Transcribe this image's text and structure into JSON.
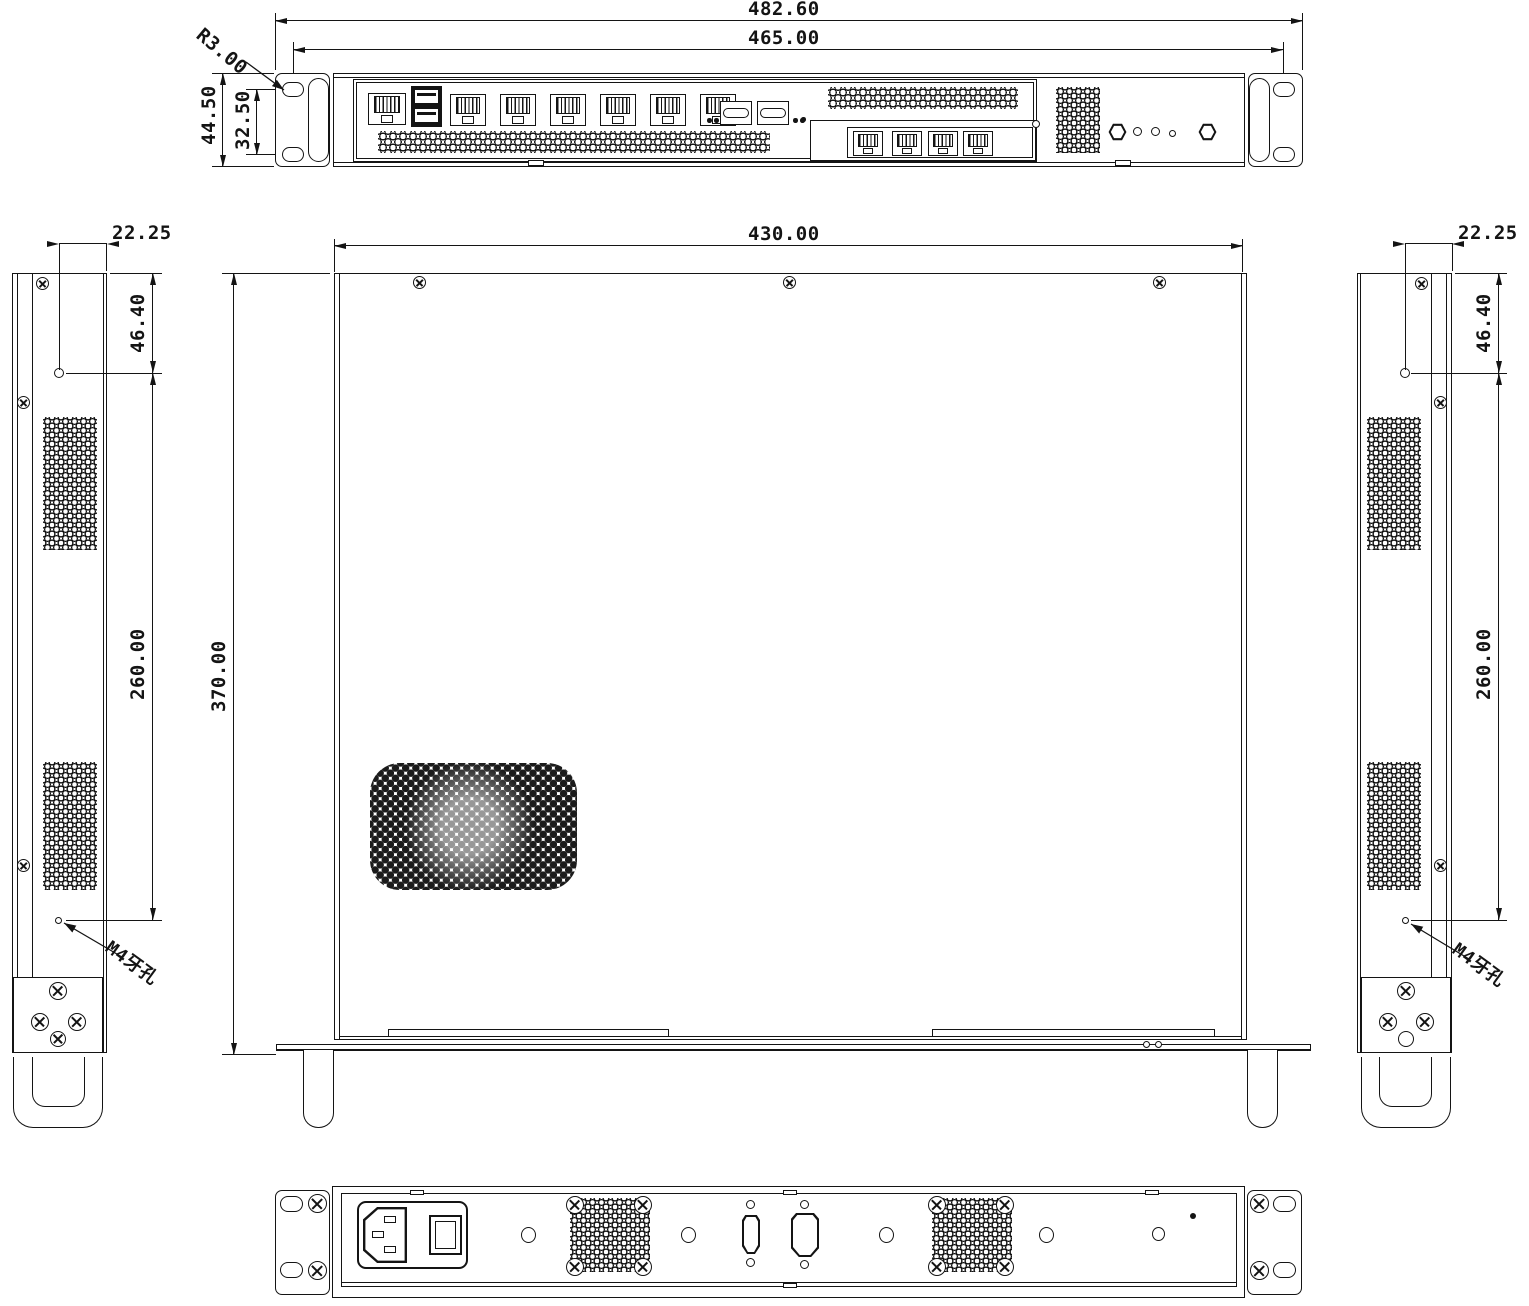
{
  "drawing_type": "mechanical-3-view-chassis-drawing",
  "dims": {
    "front": {
      "overall_width": "482.60",
      "mount_span": "465.00",
      "slot_radius": "R3.00",
      "height": "44.50",
      "slot_pitch": "32.50"
    },
    "top": {
      "width": "430.00",
      "depth": "370.00"
    },
    "left": {
      "offset": "22.25",
      "front_hole": "46.40",
      "pitch": "260.00",
      "thread": "M4牙孔"
    },
    "right": {
      "offset": "22.25",
      "front_hole": "46.40",
      "pitch": "260.00",
      "thread": "M4牙孔"
    }
  },
  "features": {
    "front_rj45_console_ports": 1,
    "front_usb_ports": 2,
    "front_lan_ports": 6,
    "front_sfp_cages": 2,
    "expansion_lan_ports": 4,
    "top_cover_screws": 3,
    "rear_fan_grilles": 2
  },
  "colors": {
    "line": "#141414",
    "background": "#ffffff"
  }
}
